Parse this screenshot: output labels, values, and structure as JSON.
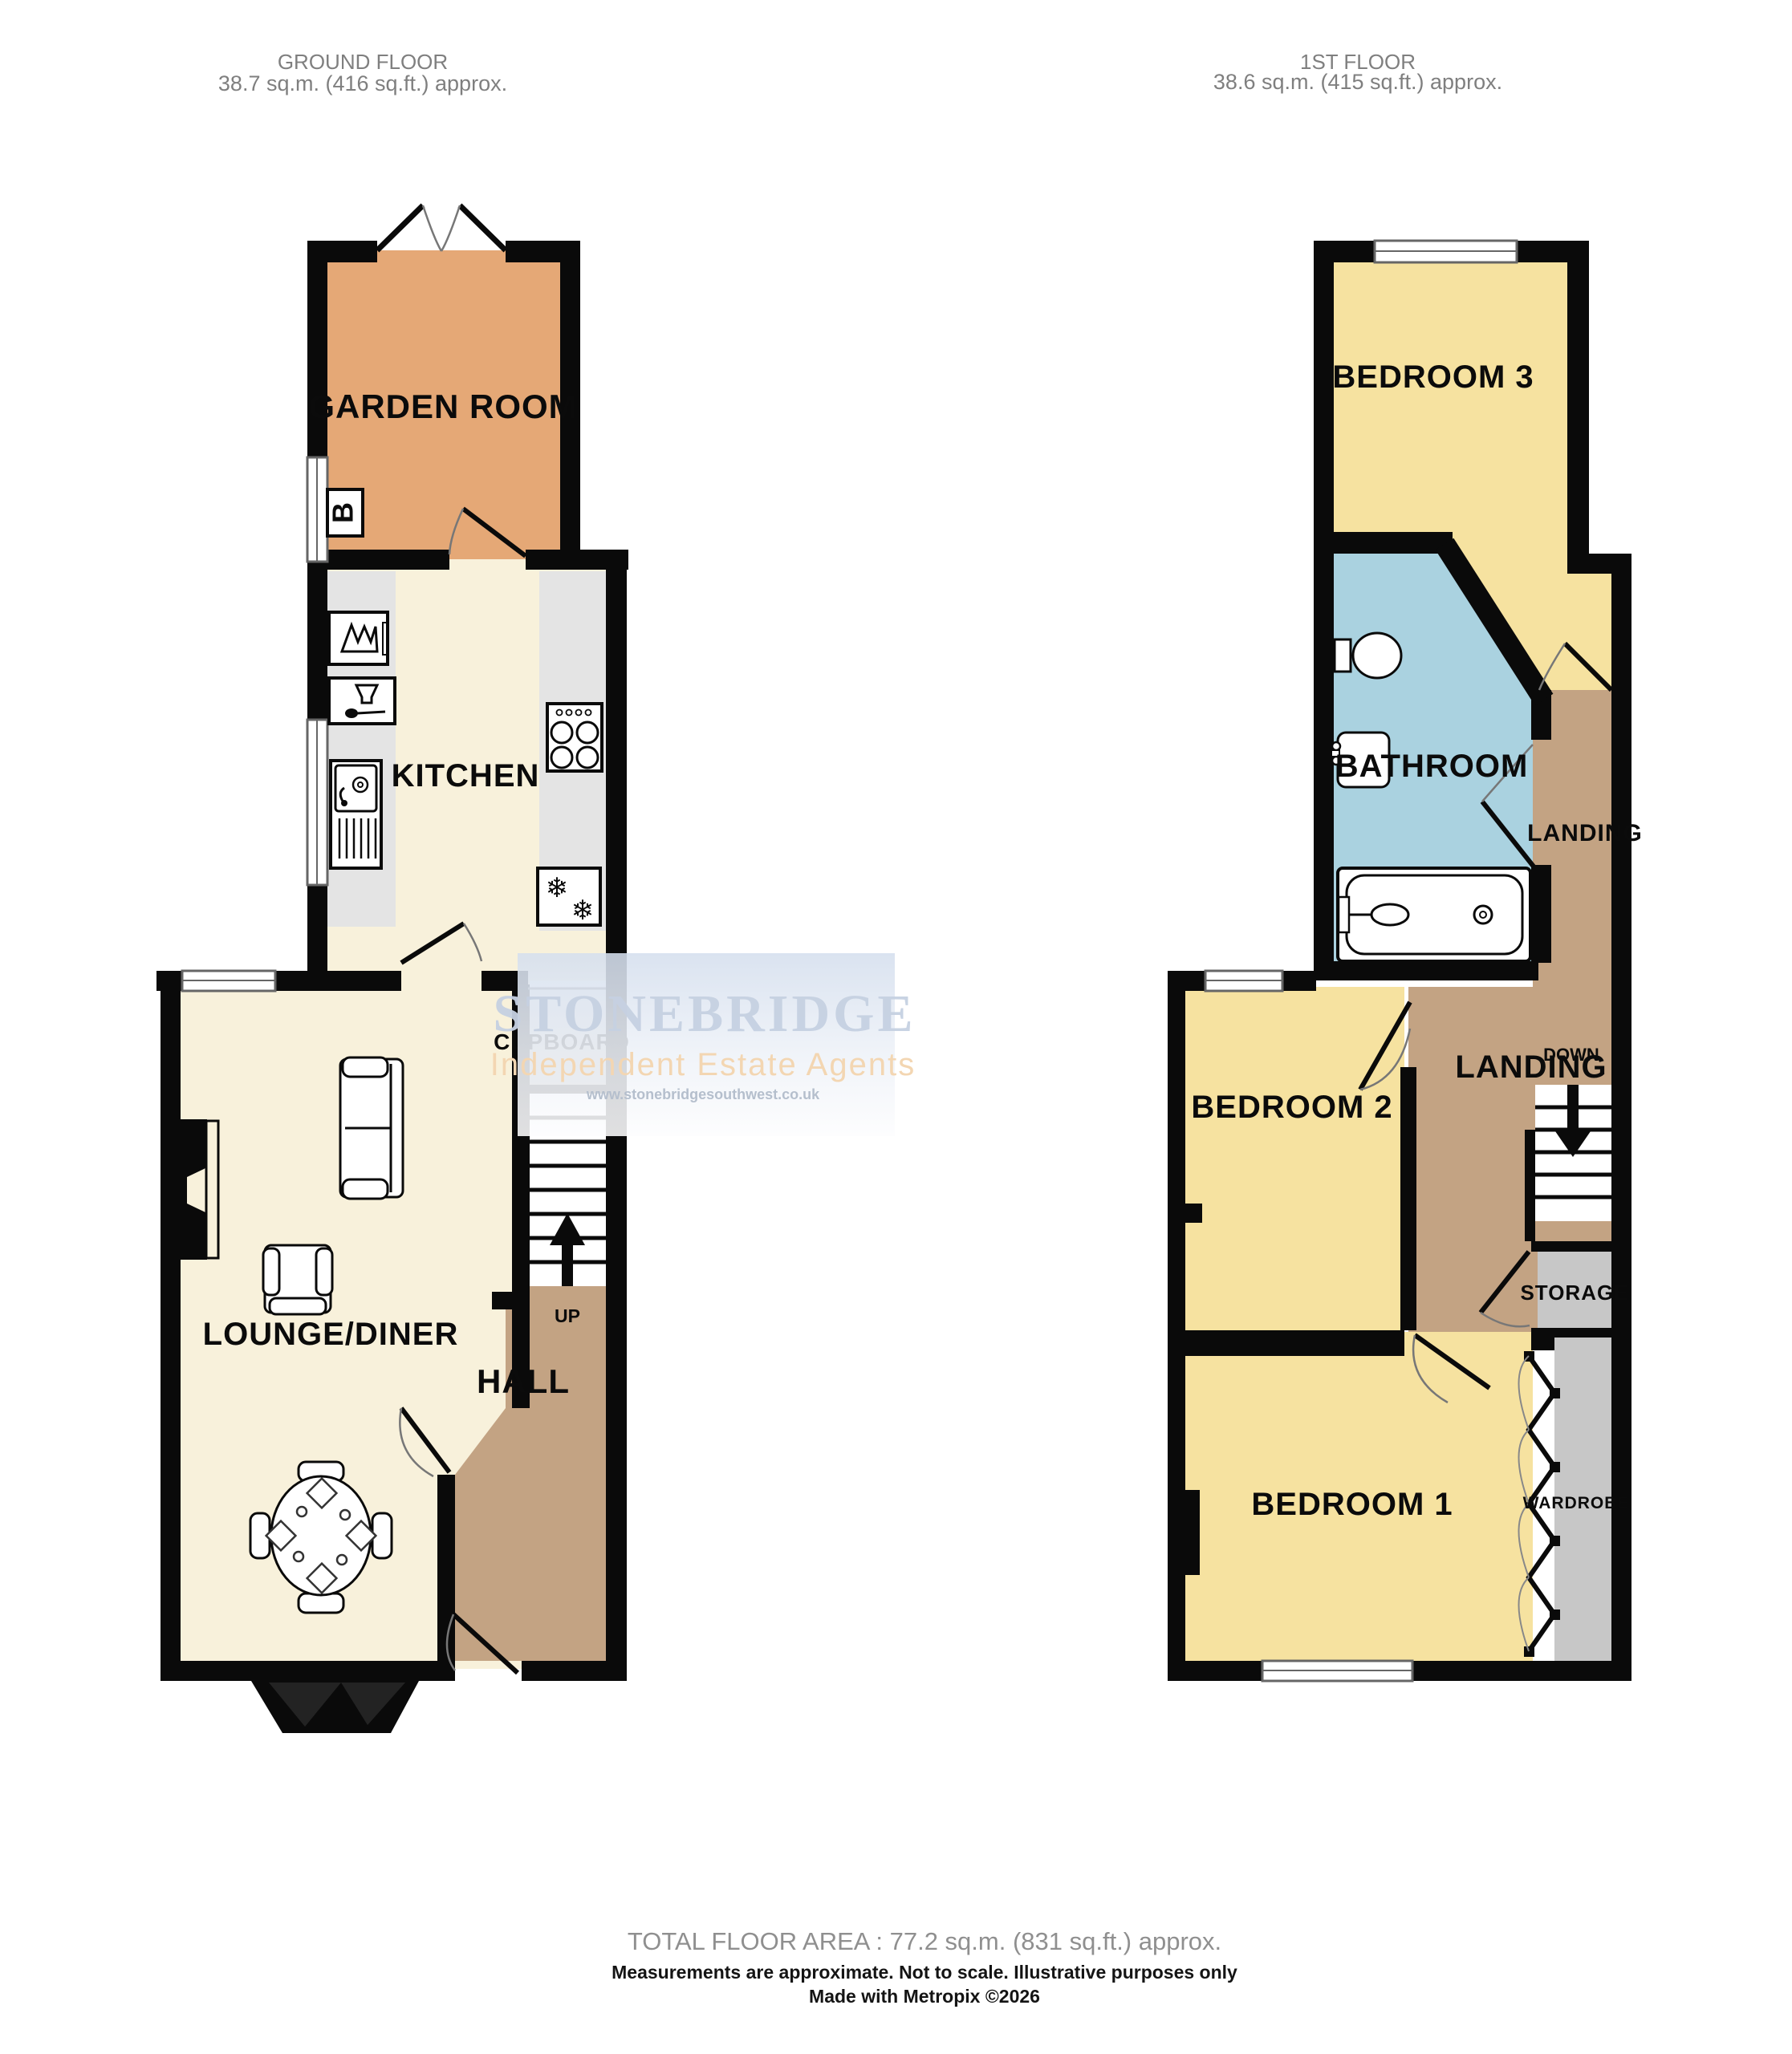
{
  "header": {
    "ground": {
      "title": "GROUND FLOOR",
      "area": "38.7 sq.m. (416 sq.ft.) approx."
    },
    "first": {
      "title": "1ST FLOOR",
      "area": "38.6 sq.m. (415 sq.ft.) approx."
    }
  },
  "rooms": {
    "garden_room": "GARDEN ROOM",
    "kitchen": "KITCHEN",
    "cupboard": "CUPBOARD",
    "lounge_diner": "LOUNGE/DINER",
    "hall": "HALL",
    "up": "UP",
    "boiler": "B",
    "bedroom3": "BEDROOM 3",
    "bathroom": "BATHROOM",
    "landing_upper": "LANDING",
    "landing": "LANDING",
    "down": "DOWN",
    "bedroom2": "BEDROOM 2",
    "storage": "STORAGE",
    "bedroom1": "BEDROOM 1",
    "wardrobe": "WARDROBE"
  },
  "icons": {
    "snowflake": "❄"
  },
  "watermark": {
    "name": "STONEBRIDGE",
    "tagline": "Independent Estate Agents",
    "url": "www.stonebridgesouthwest.co.uk"
  },
  "footer": {
    "total": "TOTAL FLOOR AREA : 77.2 sq.m. (831 sq.ft.) approx.",
    "disclaimer": "Measurements are approximate.  Not to scale.  Illustrative purposes only",
    "credit": "Made with Metropix ©2026"
  },
  "colors": {
    "wall": "#0a0a0a",
    "floor_cream": "#f8f1db",
    "garden_orange": "#e5a876",
    "bedroom_yellow": "#f6e2a0",
    "bathroom_blue": "#aad2e0",
    "hall_tan": "#c3a383",
    "counter_gray": "#e4e4e4",
    "storage_gray": "#c7c7c7",
    "watermark_blue": "#c6d1e2",
    "watermark_orange": "#f3d6b2"
  }
}
